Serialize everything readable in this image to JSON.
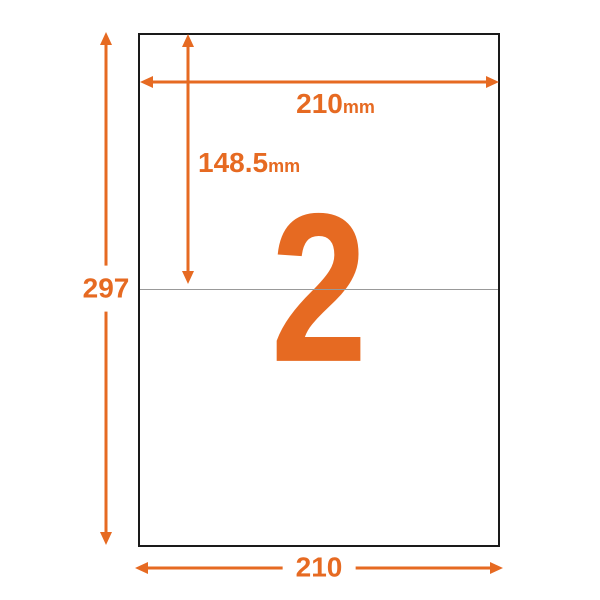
{
  "colors": {
    "accent": "#E66A22",
    "paper_border": "#1A1A1A",
    "divider": "#999999",
    "background": "#FFFFFF"
  },
  "paper": {
    "label_count": "2"
  },
  "dimensions": {
    "top_width": {
      "value": "210",
      "unit": "mm"
    },
    "half_height": {
      "value": "148.5",
      "unit": "mm"
    },
    "total_height": {
      "value": "297"
    },
    "bottom_width": {
      "value": "210"
    }
  }
}
